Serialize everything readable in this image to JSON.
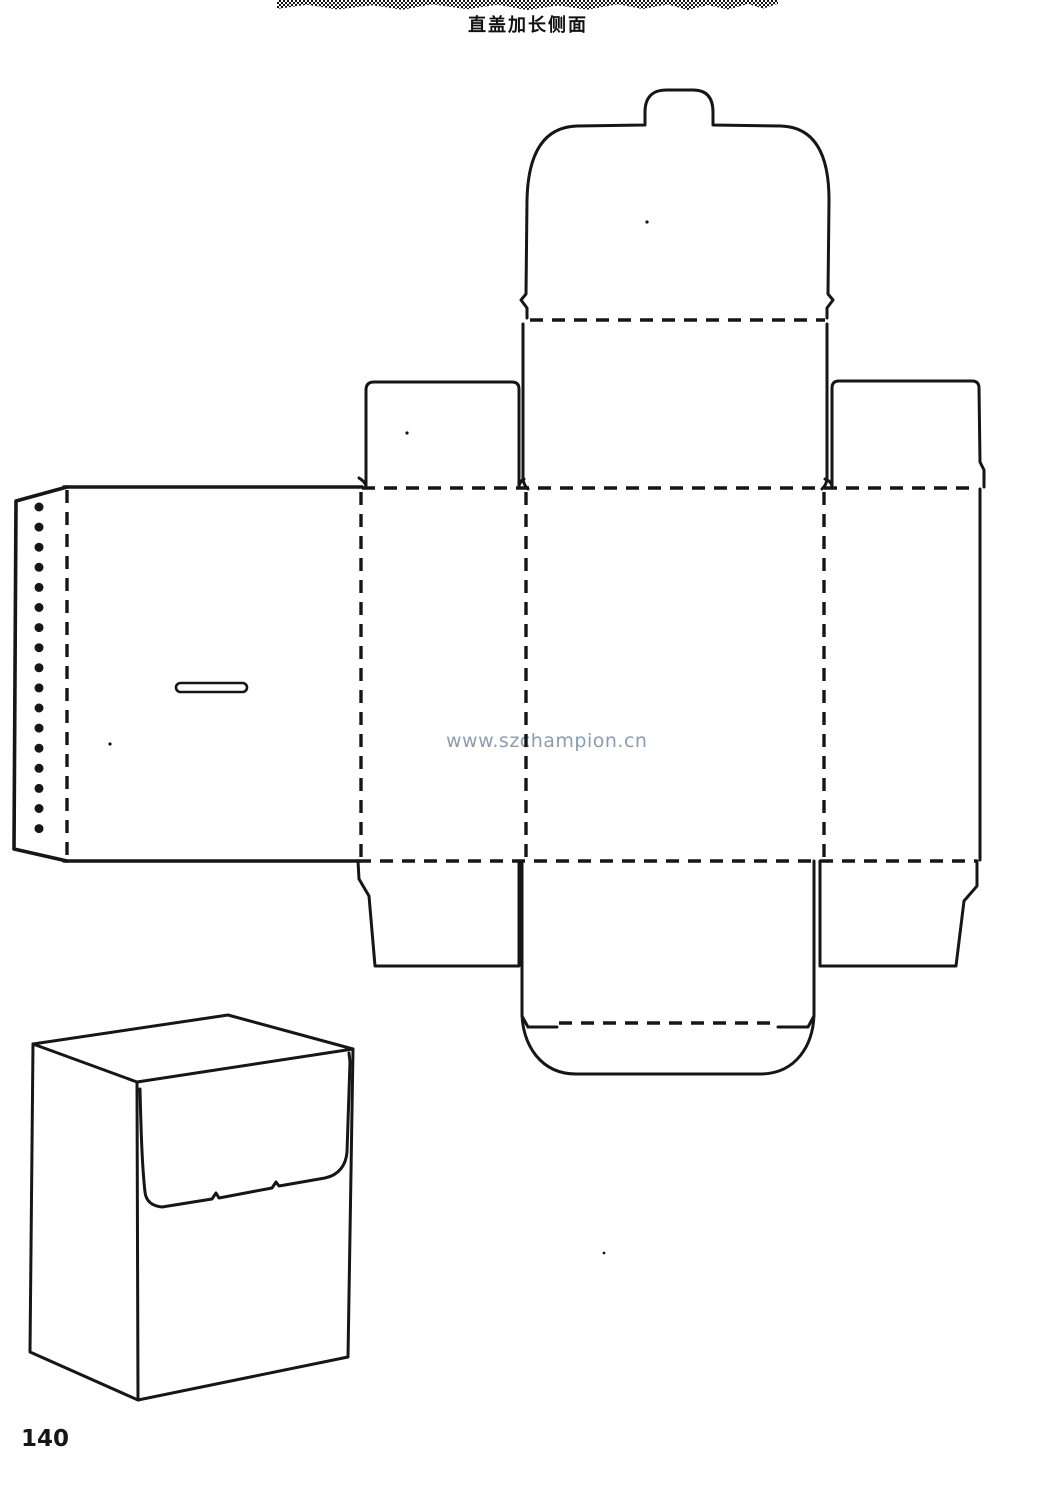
{
  "page": {
    "kind": "scanned packaging dieline page",
    "paper_color": "#ffffff",
    "ink_color": "#161616",
    "watermark_color": "#8c9db1"
  },
  "header": {
    "title": "直盖加长侧面"
  },
  "watermark": {
    "text": "www.szchampion.cn"
  },
  "footer": {
    "page_number": "140"
  }
}
